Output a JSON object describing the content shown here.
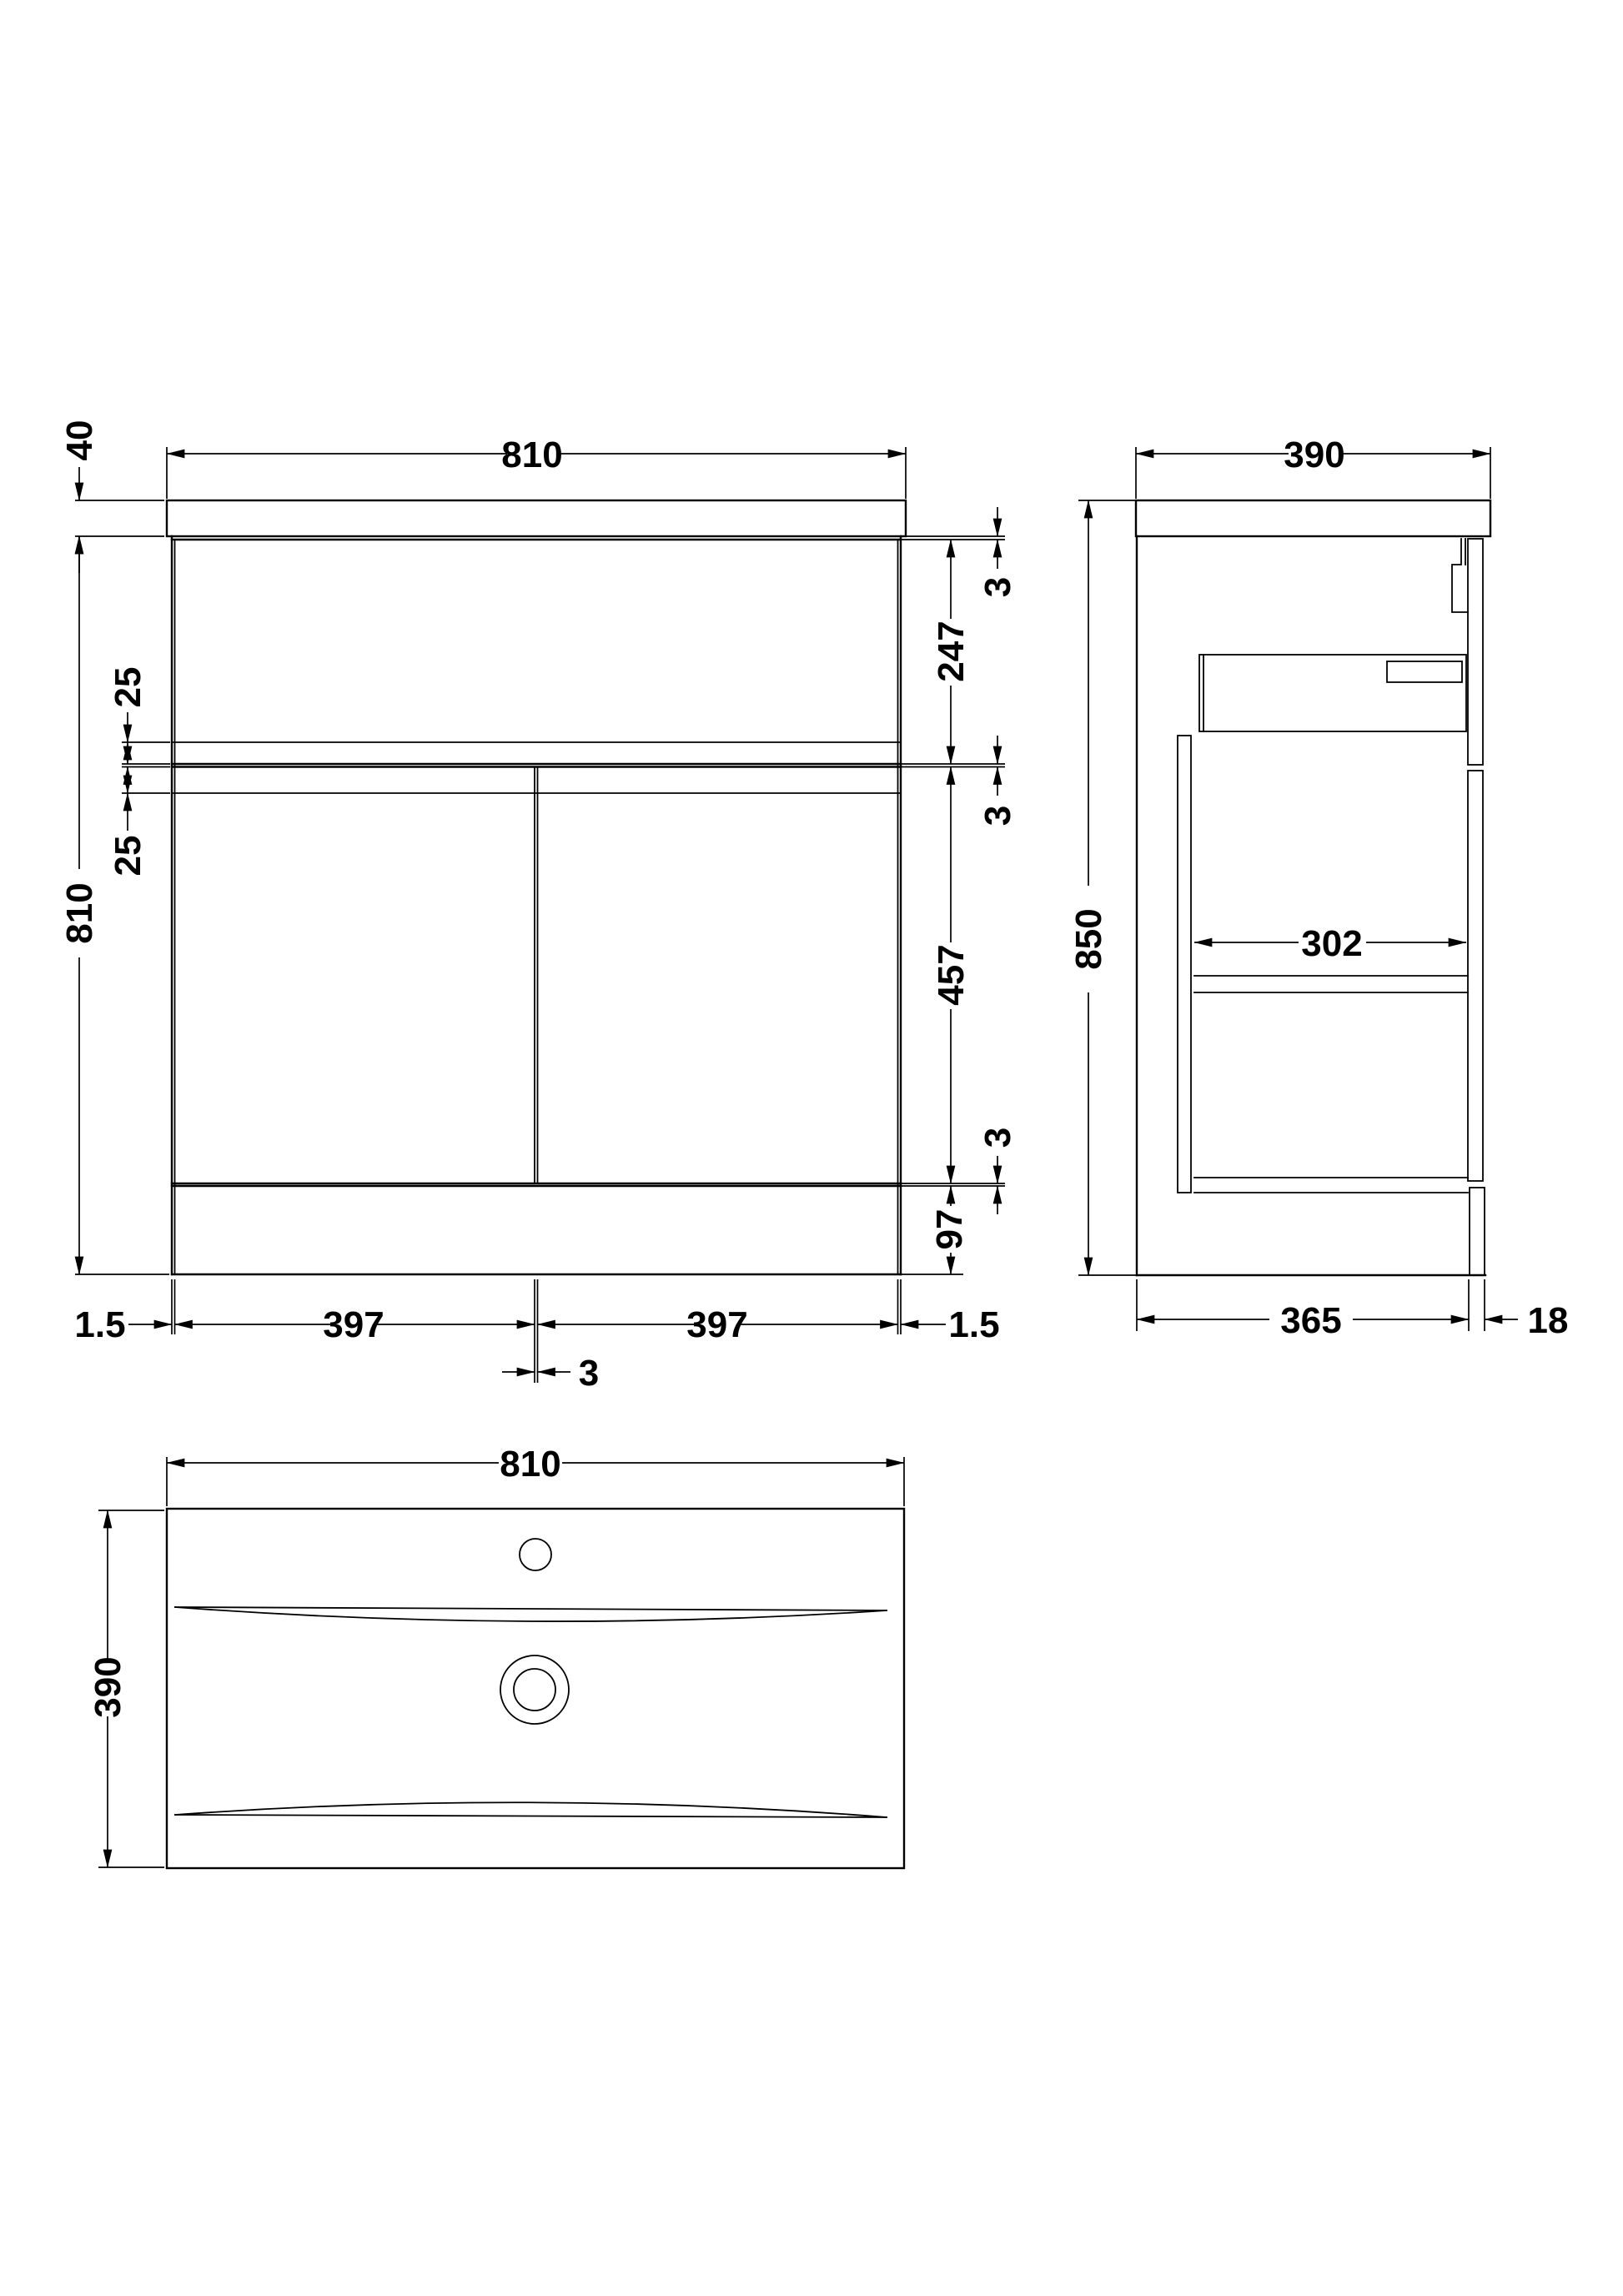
{
  "page": {
    "background": "#ffffff",
    "line_color": "#000000",
    "description": "Technical dimension drawing of a floor-standing vanity unit with basin: front elevation, side elevation and plan view"
  },
  "front_view": {
    "dims": {
      "top_width": "810",
      "countertop_thickness": "40",
      "cabinet_height": "810",
      "overlay_top": "25",
      "overlay_bottom": "25",
      "gap_top": "3",
      "drawer_front_height": "247",
      "gap_middle": "3",
      "door_height": "457",
      "gap_bottom": "3",
      "plinth_height": "97",
      "edge_gap_left": "1.5",
      "door_width_left": "397",
      "door_gap": "3",
      "door_width_right": "397",
      "edge_gap_right": "1.5"
    }
  },
  "side_view": {
    "dims": {
      "depth": "390",
      "overall_height": "850",
      "internal_depth": "302",
      "carcass_depth": "365",
      "back_panel_thickness": "18"
    }
  },
  "plan_view": {
    "dims": {
      "basin_width": "810",
      "basin_depth": "390"
    }
  }
}
